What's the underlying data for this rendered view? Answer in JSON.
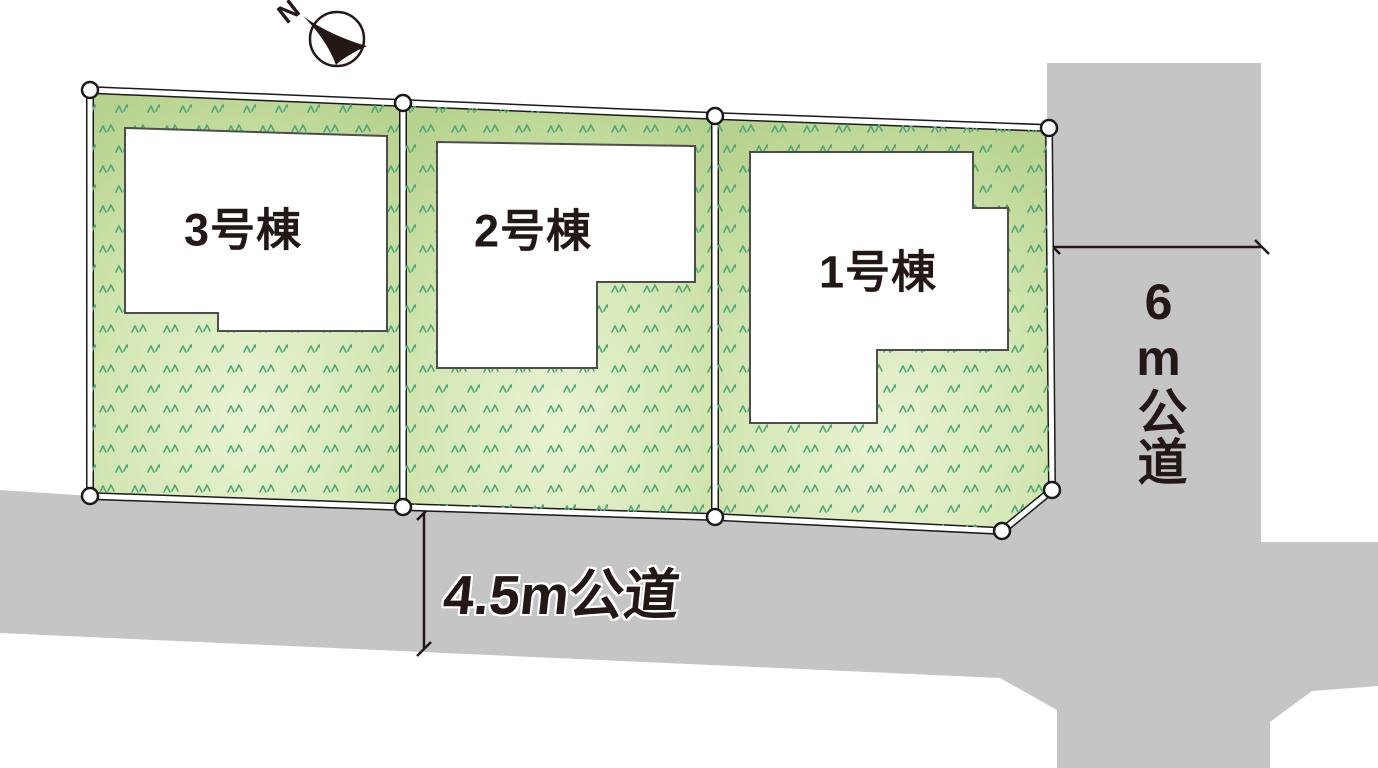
{
  "diagram": {
    "type": "lot-layout-plan",
    "compass": {
      "north_label": "N"
    },
    "plots": [
      {
        "id": "lot-3",
        "label": "3号棟"
      },
      {
        "id": "lot-2",
        "label": "2号棟"
      },
      {
        "id": "lot-1",
        "label": "1号棟"
      }
    ],
    "roads": {
      "bottom": {
        "label": "4.5m公道",
        "width_m": 4.5,
        "orientation": "horizontal"
      },
      "right": {
        "label": "6m公道",
        "width_m": 6,
        "orientation": "vertical"
      }
    },
    "colors": {
      "road_gray": "#c5c5c6",
      "plot_green_edge": "#b7d28e",
      "plot_green_center": "#e9f3d4",
      "grass_mark_green": "#4fa878",
      "ink": "#231815",
      "boundary_white": "#ffffff"
    }
  }
}
